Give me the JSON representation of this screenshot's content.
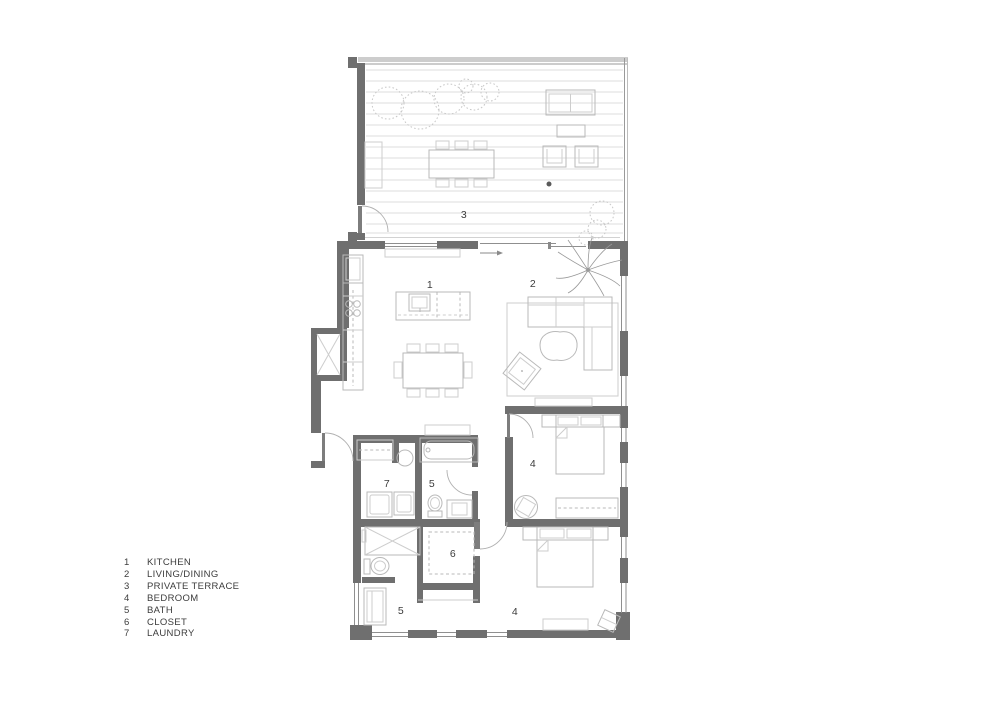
{
  "legend": {
    "items": [
      {
        "number": "1",
        "label": "KITCHEN"
      },
      {
        "number": "2",
        "label": "LIVING/DINING"
      },
      {
        "number": "3",
        "label": "PRIVATE TERRACE"
      },
      {
        "number": "4",
        "label": "BEDROOM"
      },
      {
        "number": "5",
        "label": "BATH"
      },
      {
        "number": "6",
        "label": "CLOSET"
      },
      {
        "number": "7",
        "label": "LAUNDRY"
      }
    ]
  },
  "plan": {
    "labels": [
      {
        "room": "kitchen",
        "text": "1"
      },
      {
        "room": "living-dining",
        "text": "2"
      },
      {
        "room": "private-terrace",
        "text": "3"
      },
      {
        "room": "bedroom-upper",
        "text": "4"
      },
      {
        "room": "bath-upper",
        "text": "5"
      },
      {
        "room": "laundry",
        "text": "7"
      },
      {
        "room": "closet",
        "text": "6"
      },
      {
        "room": "bath-lower",
        "text": "5"
      },
      {
        "room": "bedroom-lower",
        "text": "4"
      }
    ]
  },
  "colors": {
    "wall": "#6f6f6f",
    "line": "#b9b9b9",
    "lineLight": "#cdcdcd",
    "glass": "#8f8f8f",
    "deckLine": "#dedede",
    "text": "#3c3c3c"
  }
}
